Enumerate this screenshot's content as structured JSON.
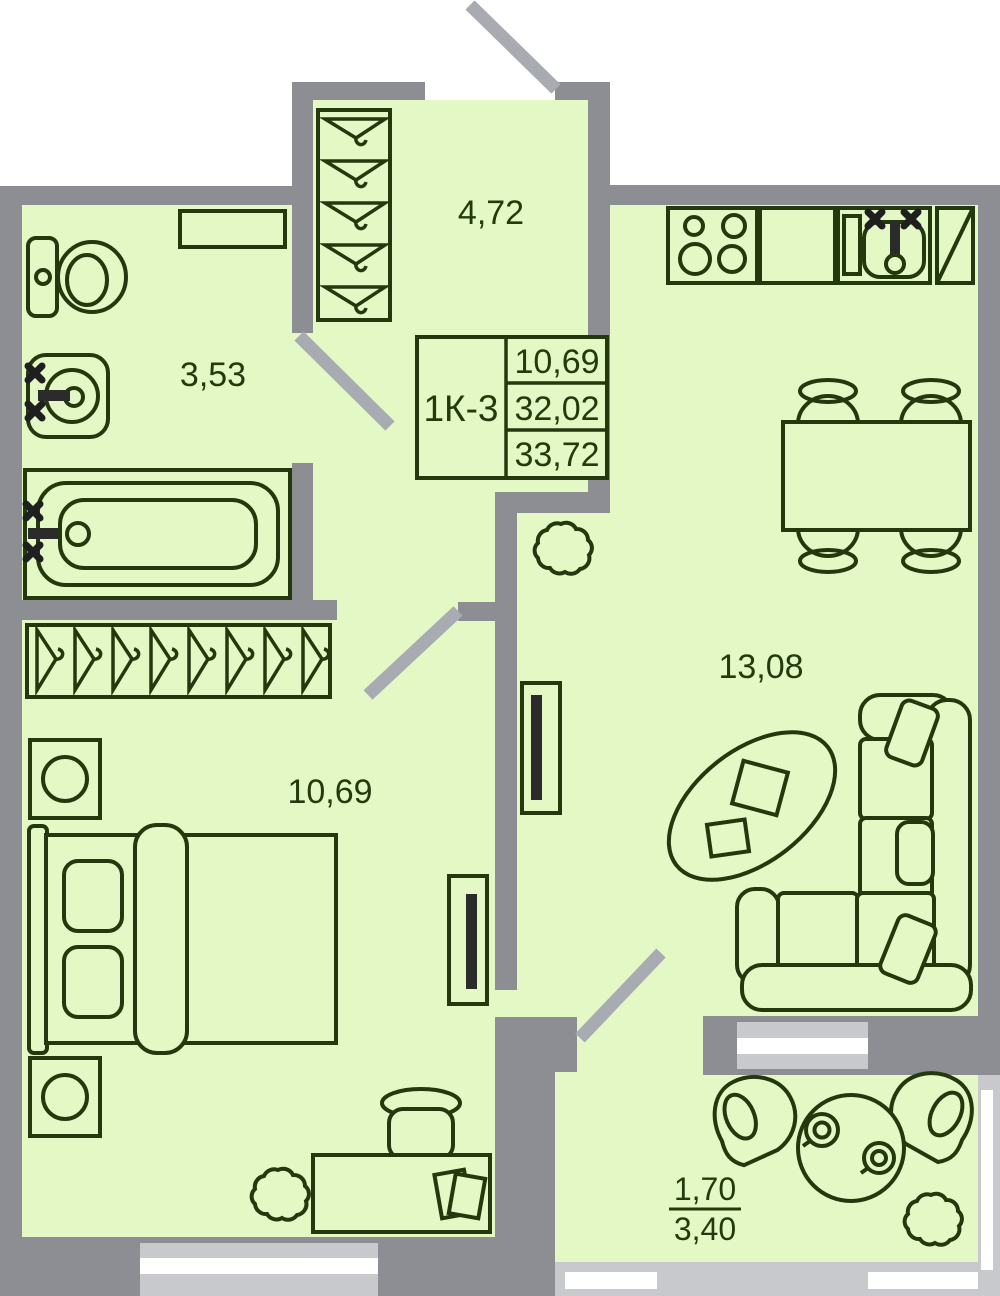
{
  "title": "apartment-floor-plan",
  "info_box": {
    "unit": "1К-3",
    "values": [
      "10,69",
      "32,02",
      "33,72"
    ]
  },
  "rooms": {
    "hall": "4,72",
    "bathroom": "3,53",
    "bedroom": "10,69",
    "living": "13,08",
    "balcony_reduced": "1,70",
    "balcony_full": "3,40"
  },
  "colors": {
    "room_fill": "#e4f8c5",
    "wall_gray": "#8d8e94",
    "door_swing_gray": "#a8abb2",
    "window_gray": "#c7c9cc",
    "window_white": "#ffffff",
    "furniture_outline": "#24380e",
    "fixture_black": "#1f1f1f",
    "background": "#ffffff"
  },
  "furniture_icons": [
    "toilet-icon",
    "washbasin-icon",
    "bathtub-icon",
    "shelf-icon",
    "coat-hanger-icon",
    "wardrobe-icon",
    "nightstand-icon",
    "double-bed-icon",
    "desk-icon",
    "stool-icon",
    "papers-icon",
    "plant-icon",
    "stove-icon",
    "kitchen-counter-icon",
    "kitchen-sink-icon",
    "fridge-icon",
    "dining-table-icon",
    "chair-icon",
    "tv-icon",
    "coffee-table-icon",
    "corner-sofa-icon",
    "round-table-icon",
    "cup-icon",
    "armchair-icon",
    "door-swing-icon",
    "window-icon"
  ]
}
